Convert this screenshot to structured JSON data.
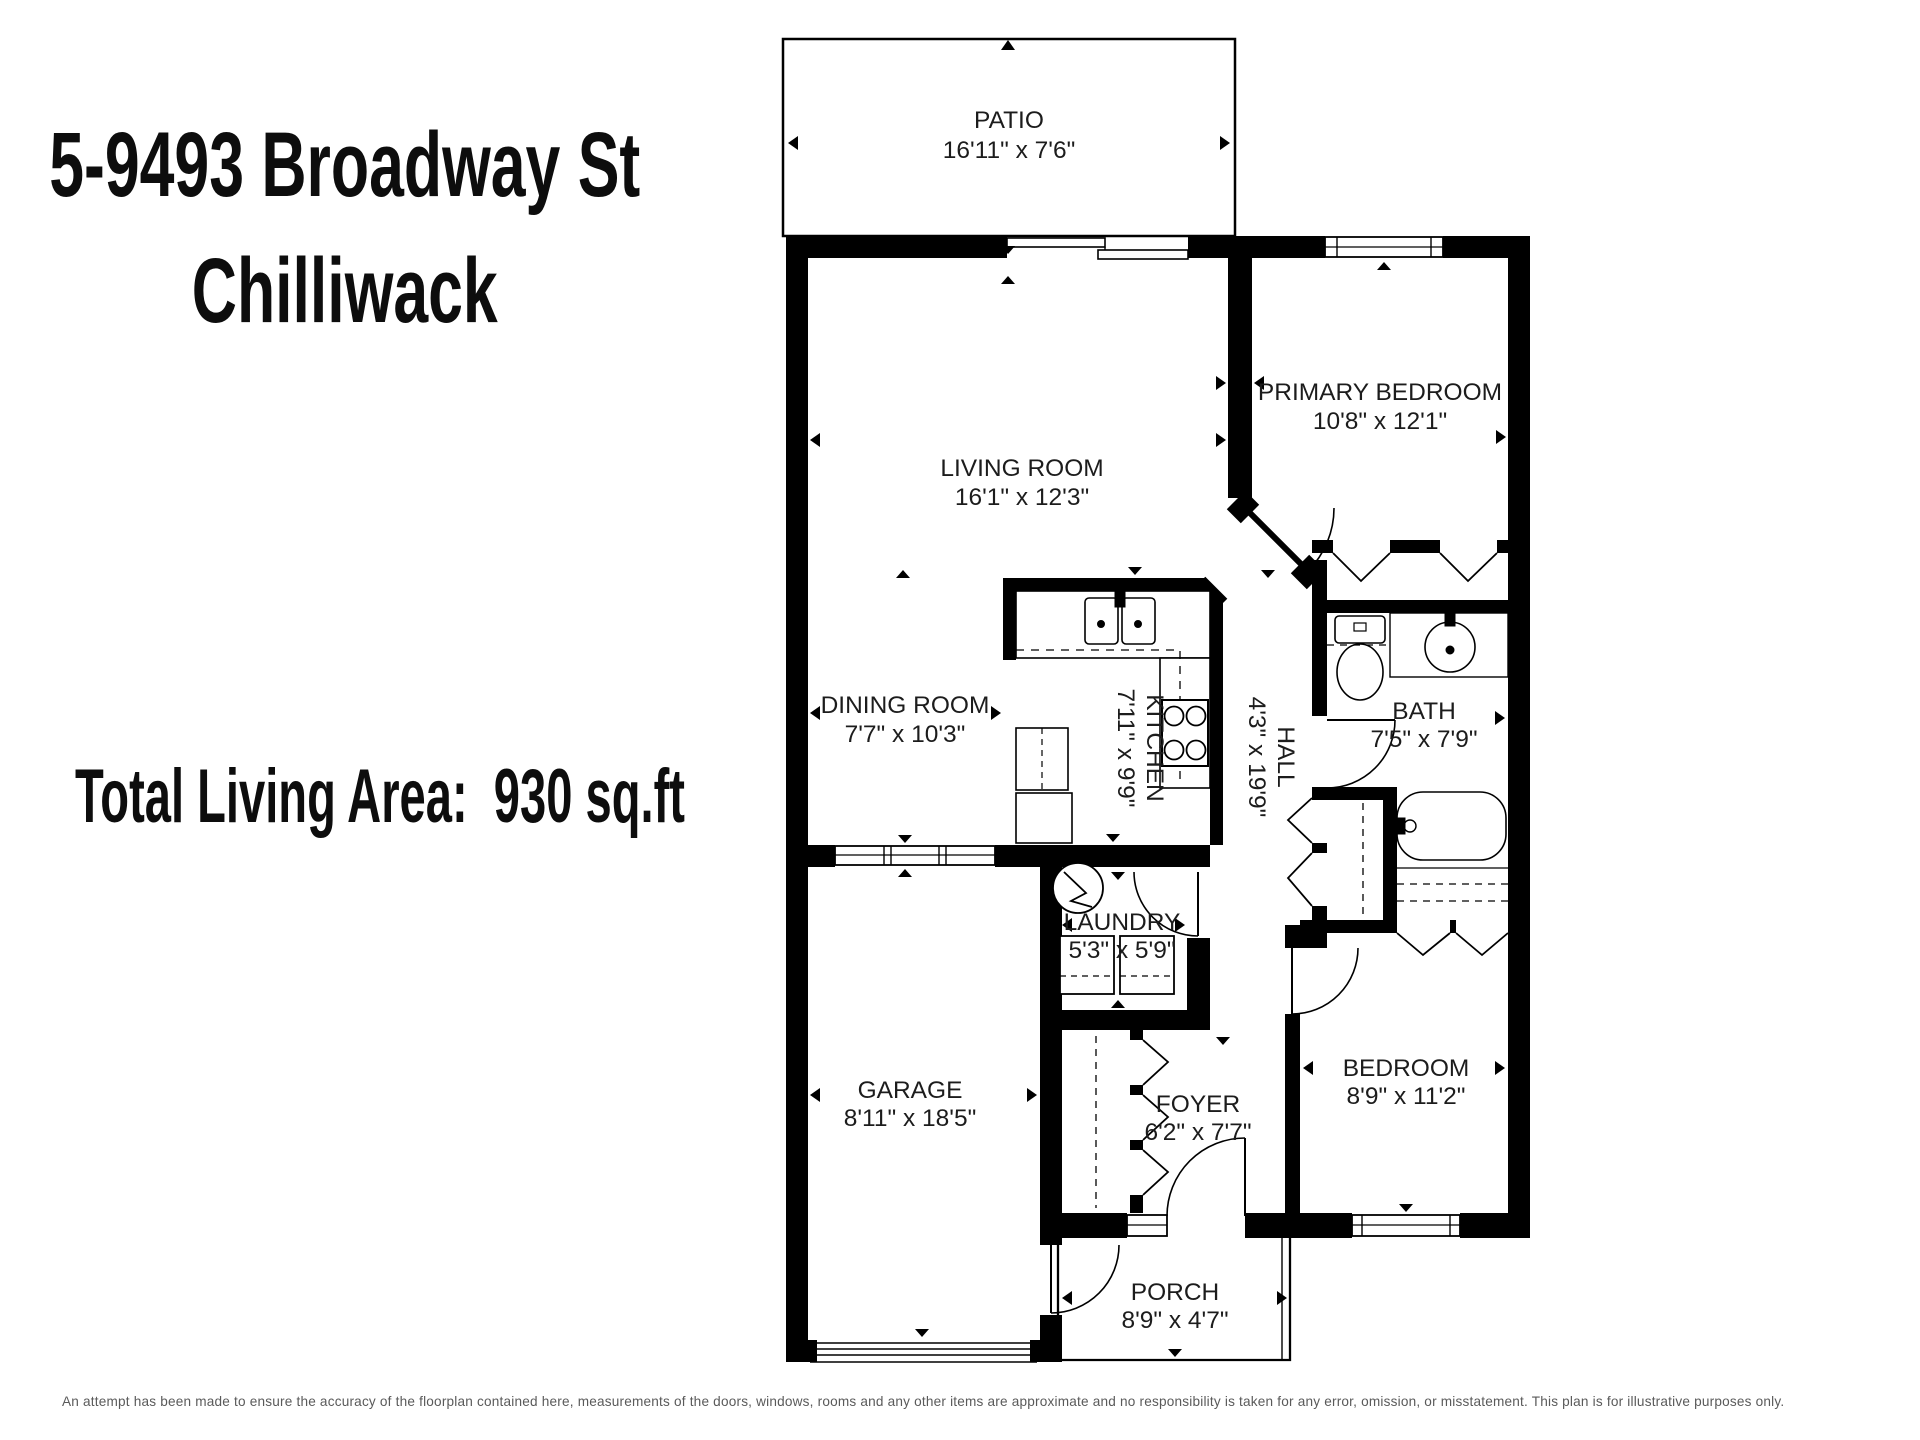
{
  "header": {
    "address_line1": "5-9493 Broadway St",
    "address_line2": "Chilliwack",
    "total_area": "Total Living Area:  930 sq.ft"
  },
  "floorplan": {
    "rooms": [
      {
        "id": "patio",
        "name": "PATIO",
        "dims": "16'11\" x 7'6\""
      },
      {
        "id": "living-room",
        "name": "LIVING ROOM",
        "dims": "16'1\" x 12'3\""
      },
      {
        "id": "primary-bedroom",
        "name": "PRIMARY BEDROOM",
        "dims": "10'8\" x 12'1\""
      },
      {
        "id": "dining-room",
        "name": "DINING ROOM",
        "dims": "7'7\" x 10'3\""
      },
      {
        "id": "kitchen",
        "name": "KITCHEN",
        "dims": "7'11\" x 9'9\""
      },
      {
        "id": "hall",
        "name": "HALL",
        "dims": "4'3\" x 19'9\""
      },
      {
        "id": "bath",
        "name": "BATH",
        "dims": "7'5\" x 7'9\""
      },
      {
        "id": "laundry",
        "name": "LAUNDRY",
        "dims": "5'3\" x 5'9\""
      },
      {
        "id": "garage",
        "name": "GARAGE",
        "dims": "8'11\" x 18'5\""
      },
      {
        "id": "foyer",
        "name": "FOYER",
        "dims": "6'2\" x 7'7\""
      },
      {
        "id": "bedroom",
        "name": "BEDROOM",
        "dims": "8'9\" x 11'2\""
      },
      {
        "id": "porch",
        "name": "PORCH",
        "dims": "8'9\" x 4'7\""
      }
    ]
  },
  "footer": {
    "disclaimer": "An attempt has been made to ensure the accuracy of the floorplan contained here, measurements of the doors, windows, rooms and any other items are approximate and no responsibility is taken for any error, omission, or misstatement. This plan is for illustrative purposes only."
  },
  "colors": {
    "wall": "#000000",
    "text": "#1c1c1c",
    "disclaimer_text": "#5a5a5a",
    "background": "#ffffff"
  }
}
